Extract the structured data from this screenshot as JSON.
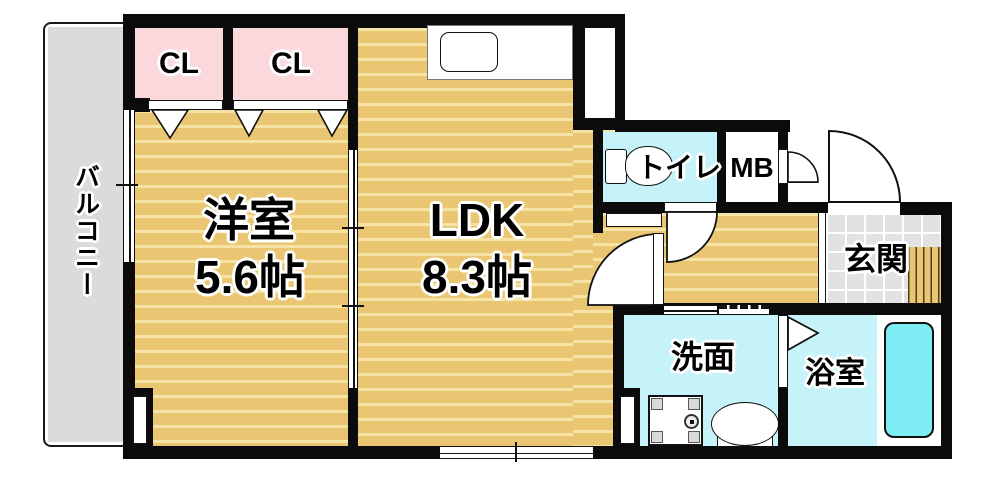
{
  "rooms": {
    "balcony": {
      "label": "バルコニー"
    },
    "closet_left": {
      "label": "CL"
    },
    "closet_right": {
      "label": "CL"
    },
    "western_room": {
      "name": "洋室",
      "size": "5.6帖"
    },
    "ldk": {
      "name": "LDK",
      "size": "8.3帖"
    },
    "toilet": {
      "label": "トイレ"
    },
    "meter_box": {
      "label": "MB"
    },
    "entrance": {
      "label": "玄関"
    },
    "washroom": {
      "label": "洗面"
    },
    "bathroom": {
      "label": "浴室"
    }
  },
  "colors": {
    "floor_tan": "#ebc672",
    "floor_stripe": "#f6e3a6",
    "closet_pink": "#fbd8dc",
    "wet_cyan": "#c6f2fa",
    "bathtub_cyan": "#7dedf3",
    "balcony_gray": "#dbdbdb",
    "tile_gray": "#e2e2e2",
    "wall_black": "#0b0b0b"
  }
}
